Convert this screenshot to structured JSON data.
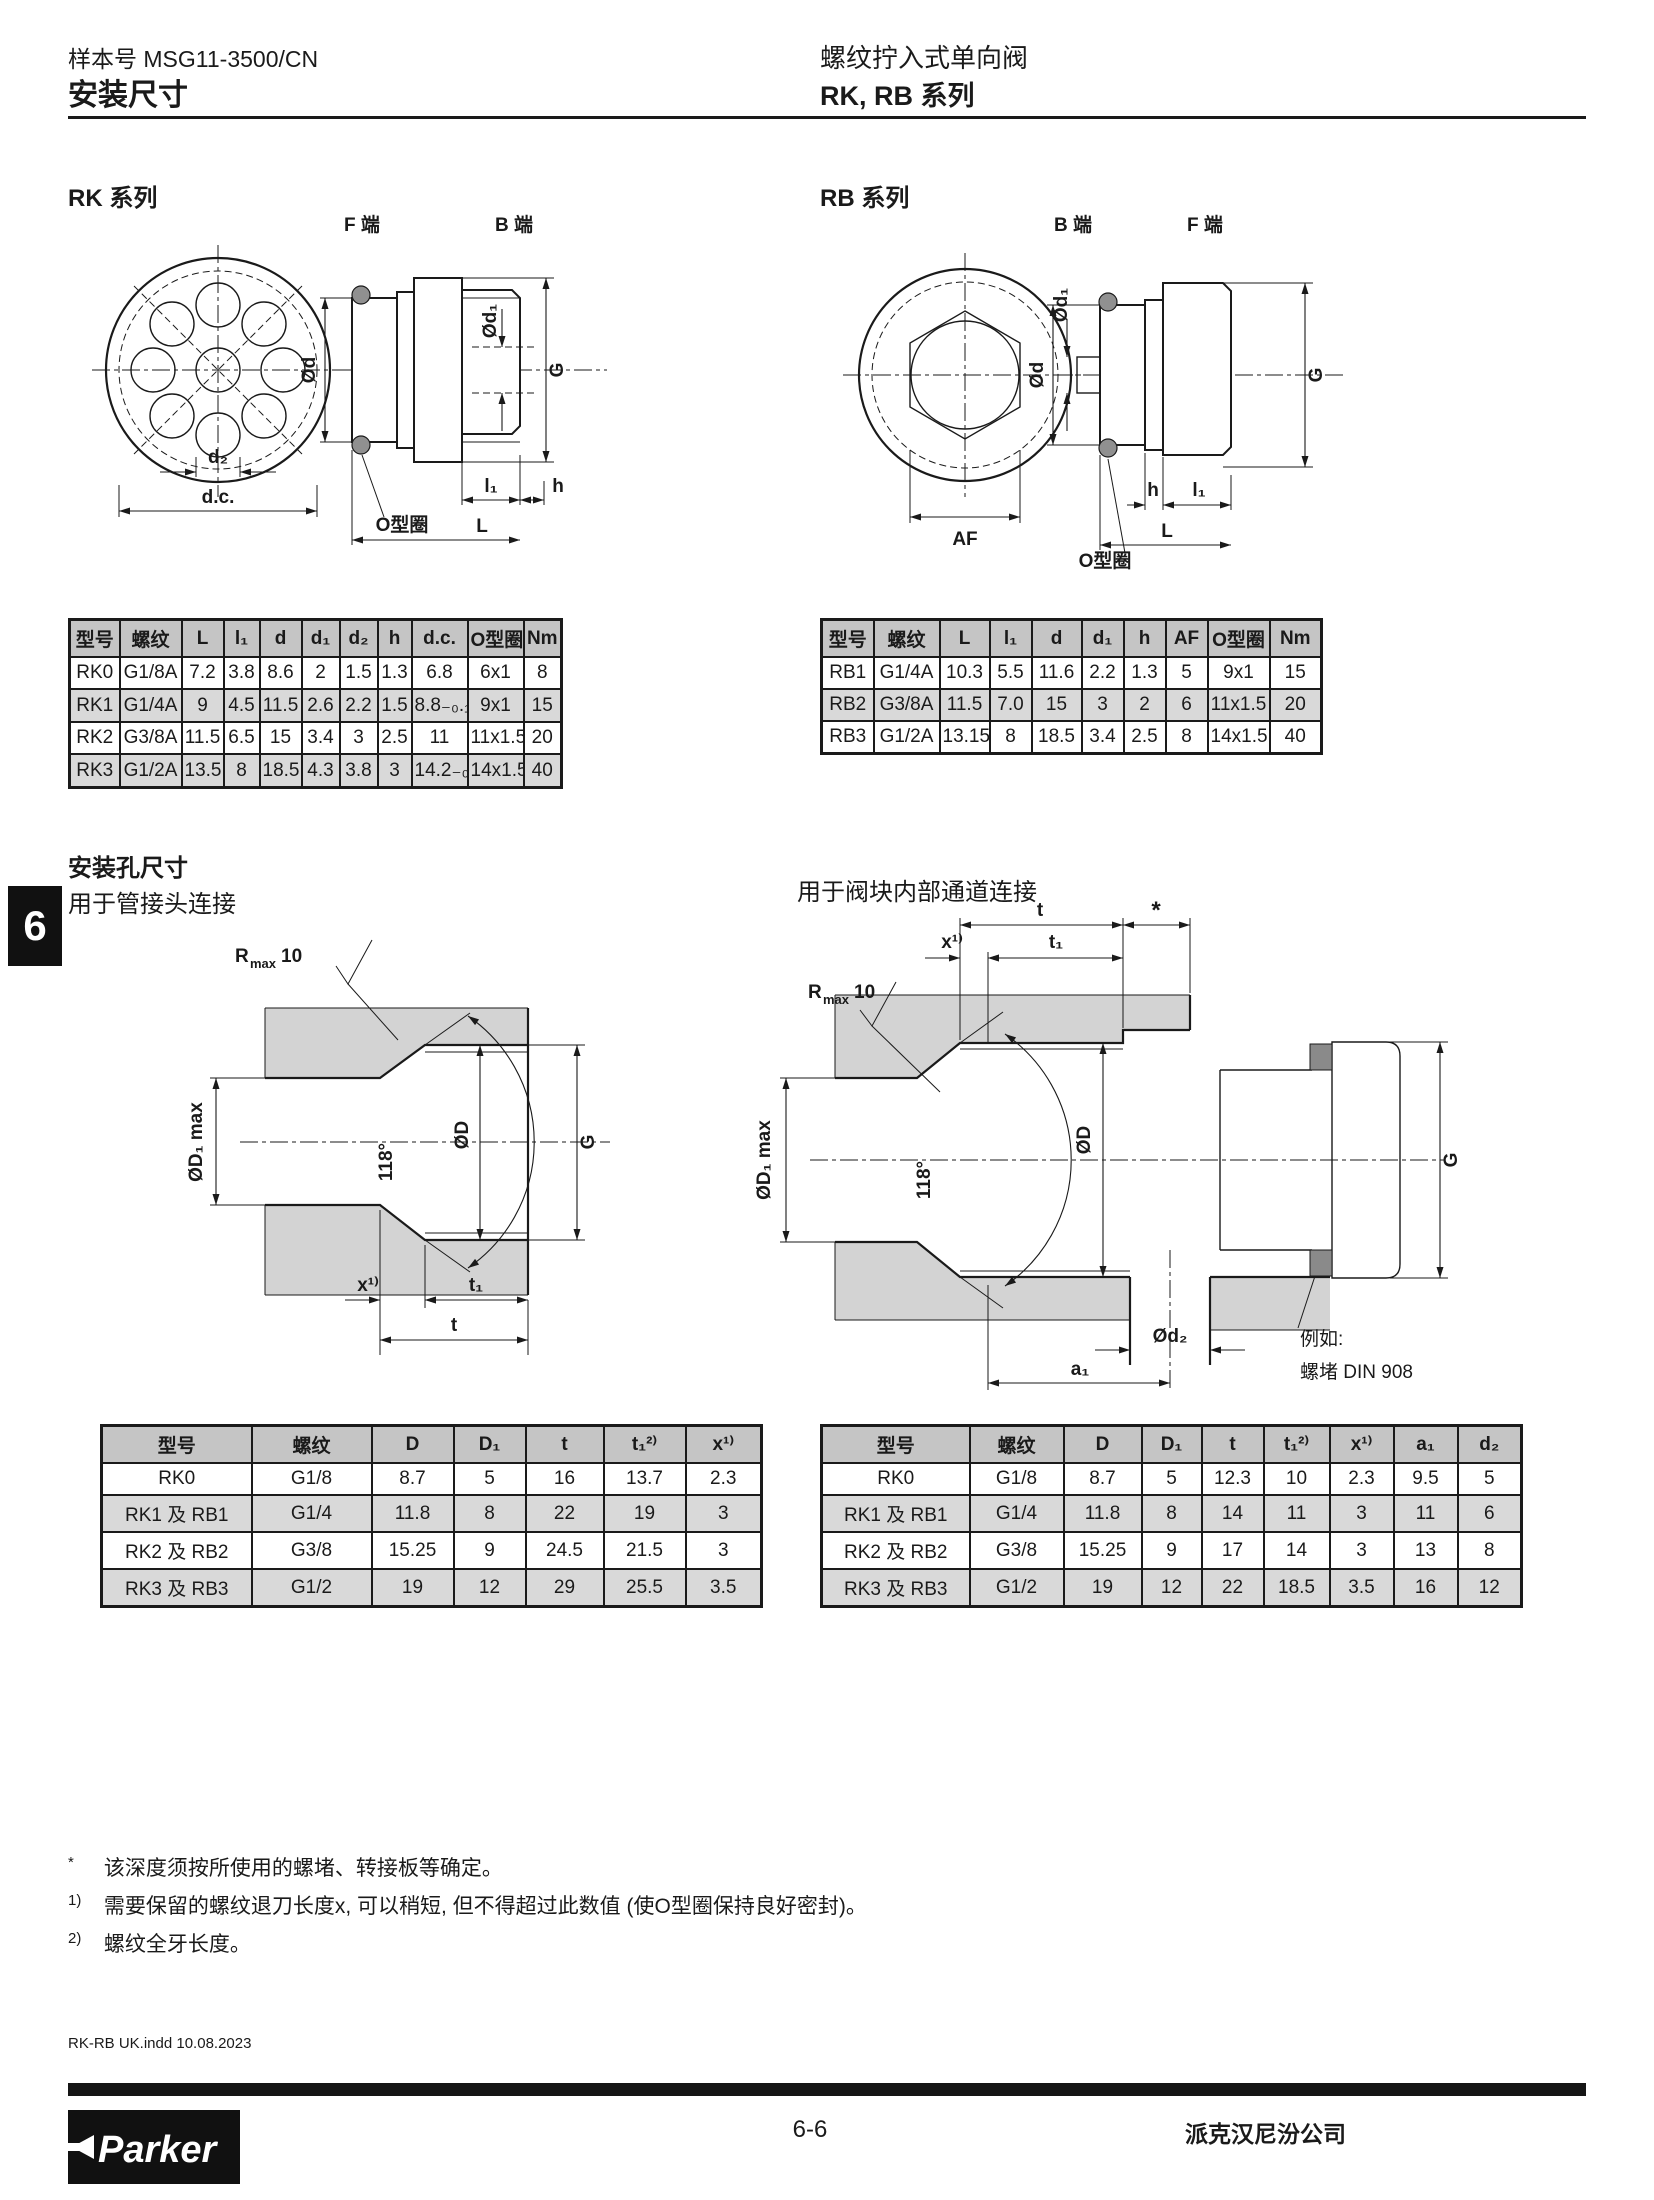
{
  "header": {
    "catalog_label": "样本号 MSG11-3500/CN",
    "page_title": "安装尺寸",
    "product_title": "螺纹拧入式单向阀",
    "series_title": "RK, RB 系列"
  },
  "tab_number": "6",
  "sections": {
    "rk_title": "RK 系列",
    "rb_title": "RB 系列",
    "mounting_title": "安装孔尺寸",
    "mounting_left_sub": "用于管接头连接",
    "mounting_right_sub": "用于阀块内部通道连接"
  },
  "diagrams": {
    "rk": {
      "f_end": "F 端",
      "b_end": "B 端",
      "dia_d": "Ød",
      "dia_d1": "Ød₁",
      "g": "G",
      "d2": "d₂",
      "dc": "d.c.",
      "oring_label": "O型圈",
      "l1": "l₁",
      "h": "h",
      "l": "L"
    },
    "rb": {
      "b_end": "B 端",
      "f_end": "F 端",
      "dia_d": "Ød",
      "dia_d1": "Ød₁",
      "g": "G",
      "af": "AF",
      "oring_label": "O型圈",
      "h": "h",
      "l1": "l₁",
      "l": "L"
    },
    "hole_left": {
      "r": "R",
      "max": "max",
      "ten": "10",
      "d1max": "ØD₁ max",
      "angle": "118°",
      "dia_d": "ØD",
      "g": "G",
      "x": "x¹⁾",
      "t1": "t₁",
      "t": "t"
    },
    "hole_right": {
      "t": "t",
      "star": "*",
      "x": "x¹⁾",
      "t1": "t₁",
      "r": "R",
      "max": "max",
      "ten": "10",
      "d1max": "ØD₁ max",
      "angle": "118°",
      "dia_d": "ØD",
      "g": "G",
      "dia_d2": "Ød₂",
      "a1": "a₁",
      "example_line1": "例如:",
      "example_line2": "螺堵 DIN 908"
    }
  },
  "tables": {
    "rk": {
      "headers": [
        "型号",
        "螺纹",
        "L",
        "l₁",
        "d",
        "d₁",
        "d₂",
        "h",
        "d.c.",
        "O型圈",
        "Nm"
      ],
      "rows": [
        [
          "RK0",
          "G1/8A",
          "7.2",
          "3.8",
          "8.6",
          "2",
          "1.5",
          "1.3",
          "6.8",
          "6x1",
          "8"
        ],
        [
          "RK1",
          "G1/4A",
          "9",
          "4.5",
          "11.5",
          "2.6",
          "2.2",
          "1.5",
          "8.8₋₀.₁",
          "9x1",
          "15"
        ],
        [
          "RK2",
          "G3/8A",
          "11.5",
          "6.5",
          "15",
          "3.4",
          "3",
          "2.5",
          "11",
          "11x1.5",
          "20"
        ],
        [
          "RK3",
          "G1/2A",
          "13.5",
          "8",
          "18.5",
          "4.3",
          "3.8",
          "3",
          "14.2₋₀.₁",
          "14x1.5",
          "40"
        ]
      ]
    },
    "rb": {
      "headers": [
        "型号",
        "螺纹",
        "L",
        "l₁",
        "d",
        "d₁",
        "h",
        "AF",
        "O型圈",
        "Nm"
      ],
      "rows": [
        [
          "RB1",
          "G1/4A",
          "10.3",
          "5.5",
          "11.6",
          "2.2",
          "1.3",
          "5",
          "9x1",
          "15"
        ],
        [
          "RB2",
          "G3/8A",
          "11.5",
          "7.0",
          "15",
          "3",
          "2",
          "6",
          "11x1.5",
          "20"
        ],
        [
          "RB3",
          "G1/2A",
          "13.15",
          "8",
          "18.5",
          "3.4",
          "2.5",
          "8",
          "14x1.5",
          "40"
        ]
      ]
    },
    "hole_left": {
      "headers": [
        "型号",
        "螺纹",
        "D",
        "D₁",
        "t",
        "t₁²⁾",
        "x¹⁾"
      ],
      "rows": [
        [
          "RK0",
          "G1/8",
          "8.7",
          "5",
          "16",
          "13.7",
          "2.3"
        ],
        [
          "RK1 及 RB1",
          "G1/4",
          "11.8",
          "8",
          "22",
          "19",
          "3"
        ],
        [
          "RK2 及 RB2",
          "G3/8",
          "15.25",
          "9",
          "24.5",
          "21.5",
          "3"
        ],
        [
          "RK3 及 RB3",
          "G1/2",
          "19",
          "12",
          "29",
          "25.5",
          "3.5"
        ]
      ]
    },
    "hole_right": {
      "headers": [
        "型号",
        "螺纹",
        "D",
        "D₁",
        "t",
        "t₁²⁾",
        "x¹⁾",
        "a₁",
        "d₂"
      ],
      "rows": [
        [
          "RK0",
          "G1/8",
          "8.7",
          "5",
          "12.3",
          "10",
          "2.3",
          "9.5",
          "5"
        ],
        [
          "RK1 及 RB1",
          "G1/4",
          "11.8",
          "8",
          "14",
          "11",
          "3",
          "11",
          "6"
        ],
        [
          "RK2 及 RB2",
          "G3/8",
          "15.25",
          "9",
          "17",
          "14",
          "3",
          "13",
          "8"
        ],
        [
          "RK3 及 RB3",
          "G1/2",
          "19",
          "12",
          "22",
          "18.5",
          "3.5",
          "16",
          "12"
        ]
      ]
    }
  },
  "footnotes": [
    {
      "marker": "*",
      "text": "该深度须按所使用的螺堵、转接板等确定。"
    },
    {
      "marker": "1)",
      "text": "需要保留的螺纹退刀长度x, 可以稍短, 但不得超过此数值 (使O型圈保持良好密封)。"
    },
    {
      "marker": "2)",
      "text": "螺纹全牙长度。"
    }
  ],
  "footer": {
    "print_info": "RK-RB UK.indd 10.08.2023",
    "logo_text": "Parker",
    "page_number": "6-6",
    "company": "派克汉尼汾公司"
  }
}
